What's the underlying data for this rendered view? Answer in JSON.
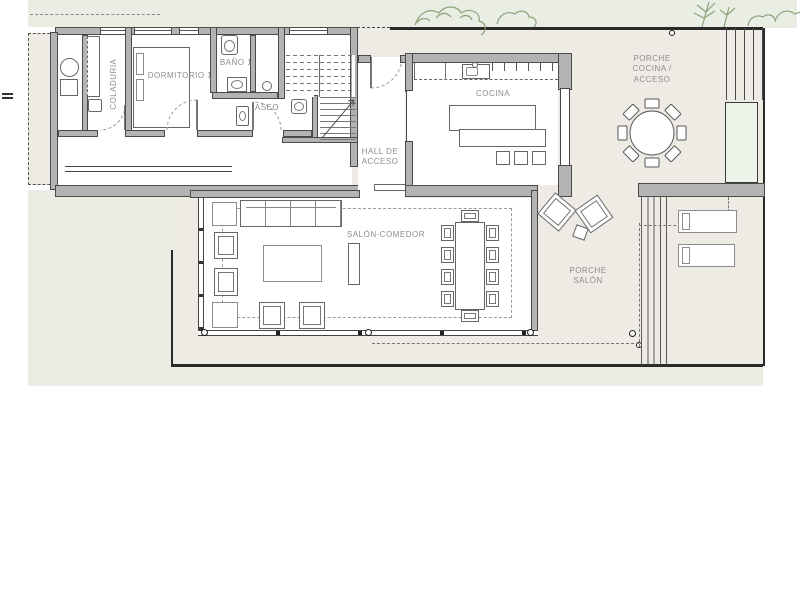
{
  "plan": {
    "rooms": {
      "coladuria": "COLADURIA",
      "dormitorio_1": "DORMITORIO 1",
      "bano_1": "BAÑO 1",
      "aseo": "ASEO",
      "hall": "HALL DE ACCESO",
      "cocina": "COCINA",
      "porche_cocina": "PORCHE COCINA / ACCESO",
      "salon_comedor": "SALÓN-COMEDOR",
      "porche_salon": "PORCHE SALÓN"
    },
    "palette": {
      "background": "#ffffff",
      "garden_green": "#e9ede3",
      "porch_beige": "#edebe4",
      "planter_green": "#eef3ea",
      "wall_fill": "#b3b3b3",
      "wall_edge": "#4a4a4a",
      "boundary_dark": "#2a2a2a",
      "furniture_line": "#6a6a6a",
      "label_gray": "#8d8d8d",
      "plant_stroke": "#8ba37a"
    }
  }
}
